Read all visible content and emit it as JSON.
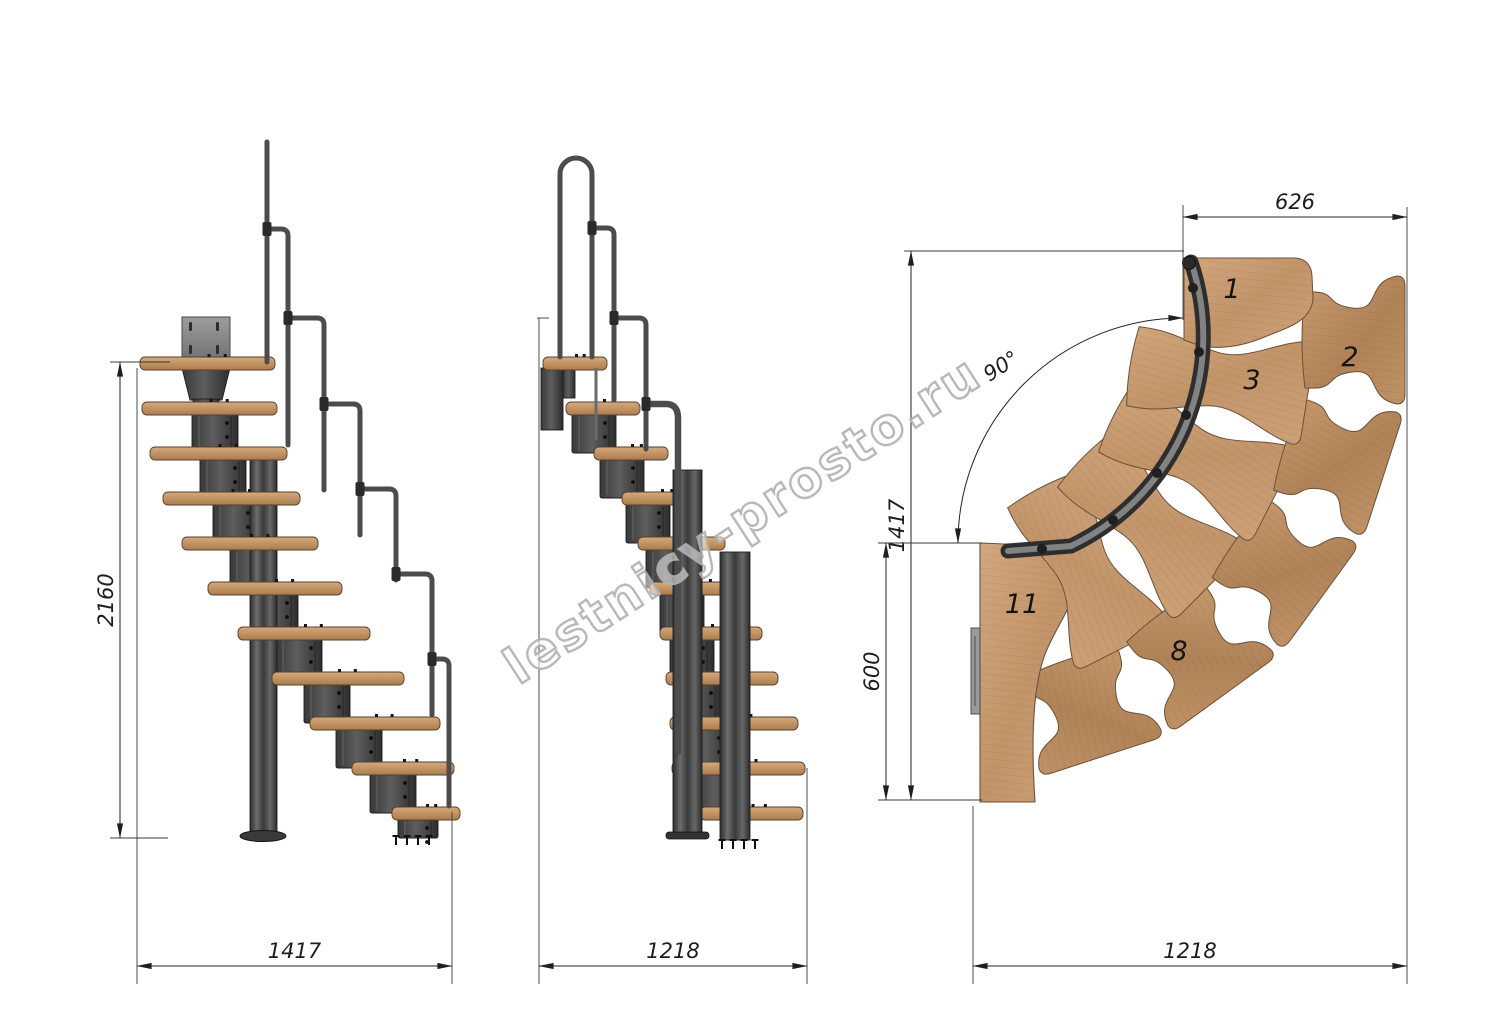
{
  "drawing": {
    "type": "staircase-technical-drawing",
    "watermark": "lestnicy-prosto.ru",
    "views": {
      "side": {
        "name": "side-elevation",
        "dim_height": "2160",
        "dim_width": "1417",
        "tread_count": 11
      },
      "front": {
        "name": "front-elevation",
        "dim_width": "1218",
        "tread_count": 11
      },
      "plan": {
        "name": "plan-view-90-turn",
        "dim_top": "626",
        "dim_angle": "90°",
        "dim_side": "1417",
        "dim_offset": "600",
        "dim_bottom": "1218",
        "tread_labels": [
          {
            "n": "1"
          },
          {
            "n": "2"
          },
          {
            "n": "3"
          },
          {
            "n": "8"
          },
          {
            "n": "11"
          }
        ]
      }
    },
    "colors": {
      "wood": "#c79b6f",
      "wood_dark": "#ad7f55",
      "metal": "#4a4a4a",
      "line": "#2b2b2b",
      "watermark": "#b2b2b2",
      "background": "#ffffff"
    }
  }
}
